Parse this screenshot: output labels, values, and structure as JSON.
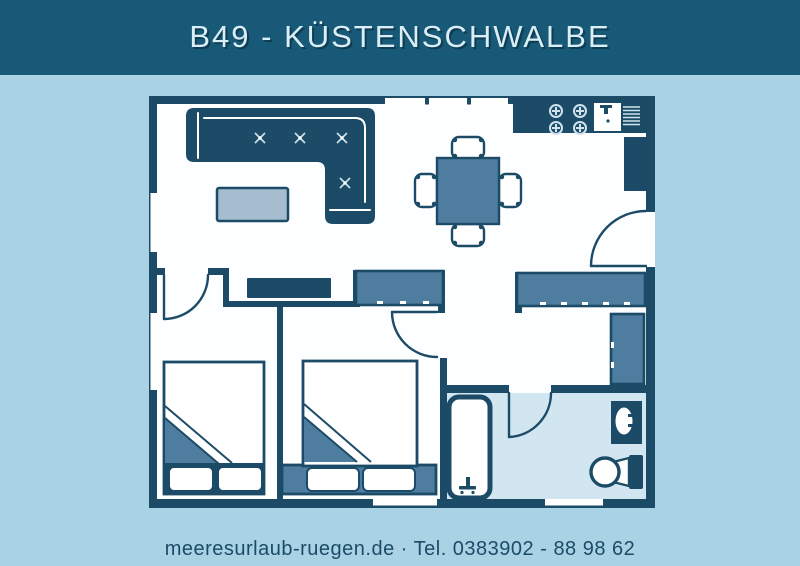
{
  "header": {
    "title": "B49 - KÜSTENSCHWALBE"
  },
  "footer": {
    "text": "meeresurlaub-ruegen.de · Tel. 0383902 - 88 98 62"
  },
  "colors": {
    "page_bg": "#a9d2e5",
    "header_bg": "#175977",
    "header_text": "#d9eef6",
    "header_text_shadow": "#0e3c52",
    "wall_dark": "#1c4b67",
    "floor_white": "#fdfeff",
    "furniture_medium": "#4e7da0",
    "coffee_table_gray": "#a6bdcf",
    "bathroom_floor": "#d2e6f1",
    "accent_light": "#cfe3ee",
    "footer_text": "#1c4b67"
  },
  "floorplan": {
    "objects": [
      "corner-sofa",
      "coffee-table",
      "sideboard",
      "dining-table",
      "dining-chair",
      "stove-burners",
      "kitchen-sink",
      "vent-grille",
      "refrigerator",
      "entrance-door",
      "hall-wardrobe",
      "hall-cabinet",
      "bedroom-wardrobe",
      "double-bed-1",
      "double-bed-2",
      "bathtub",
      "washbasin",
      "toilet",
      "window",
      "interior-door"
    ]
  }
}
